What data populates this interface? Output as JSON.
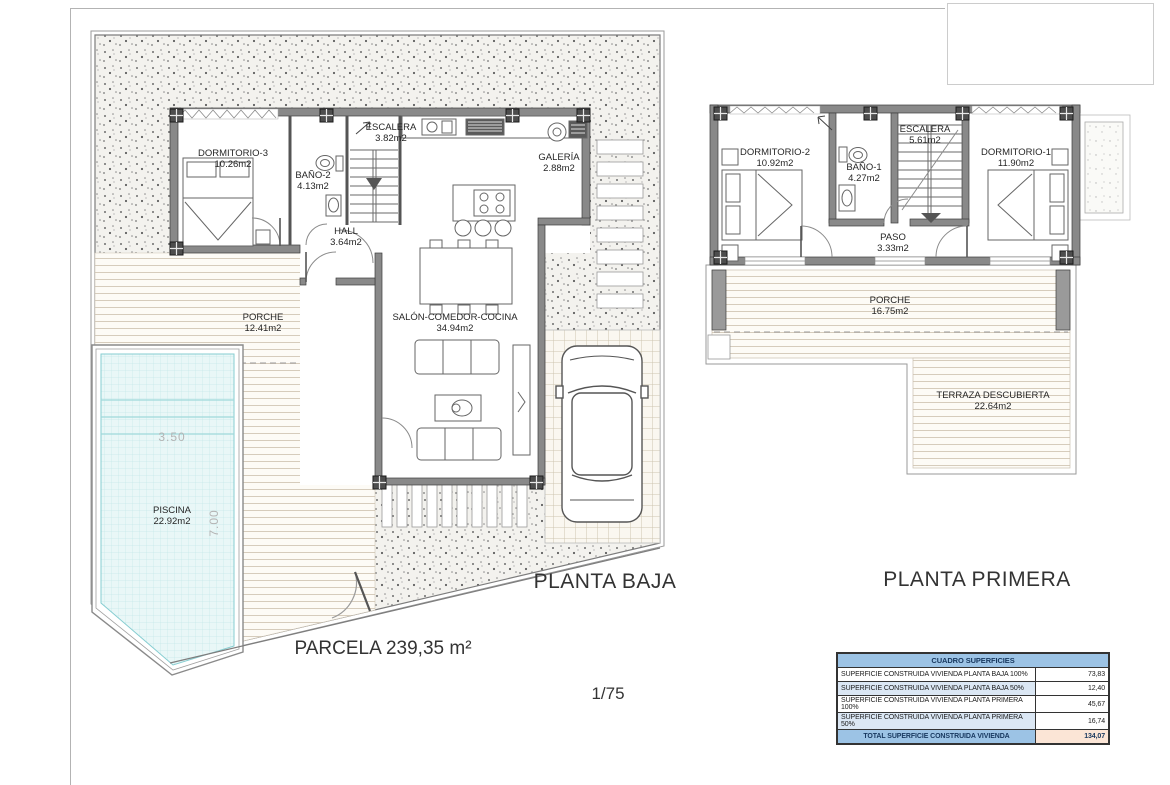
{
  "drawing": {
    "parcel_label": "PARCELA 239,35 m²",
    "scale": "1/75"
  },
  "floors": {
    "ground": {
      "title": "PLANTA BAJA",
      "rooms": [
        {
          "name": "DORMITORIO-3",
          "area": "10.26m2"
        },
        {
          "name": "BAÑO-2",
          "area": "4.13m2"
        },
        {
          "name": "ESCALERA",
          "area": "3.82m2"
        },
        {
          "name": "GALERÍA",
          "area": "2.88m2"
        },
        {
          "name": "HALL",
          "area": "3.64m2"
        },
        {
          "name": "SALÓN-COMEDOR-COCINA",
          "area": "34.94m2"
        },
        {
          "name": "PORCHE",
          "area": "12.41m2"
        },
        {
          "name": "PISCINA",
          "area": "22.92m2"
        }
      ],
      "pool_dims": {
        "width": "3.50",
        "length": "7.00"
      }
    },
    "first": {
      "title": "PLANTA PRIMERA",
      "rooms": [
        {
          "name": "DORMITORIO-2",
          "area": "10.92m2"
        },
        {
          "name": "BAÑO-1",
          "area": "4.27m2"
        },
        {
          "name": "ESCALERA",
          "area": "5.61m2"
        },
        {
          "name": "DORMITORIO-1",
          "area": "11.90m2"
        },
        {
          "name": "PASO",
          "area": "3.33m2"
        },
        {
          "name": "PORCHE",
          "area": "16.75m2"
        },
        {
          "name": "TERRAZA DESCUBIERTA",
          "area": "22.64m2"
        }
      ]
    }
  },
  "table": {
    "title": "CUADRO SUPERFICIES",
    "rows": [
      {
        "label": "SUPERFICIE CONSTRUIDA VIVIENDA PLANTA BAJA 100%",
        "value": "73,83"
      },
      {
        "label": "SUPERFICIE CONSTRUIDA VIVIENDA PLANTA BAJA 50%",
        "value": "12,40"
      },
      {
        "label": "SUPERFICIE CONSTRUIDA VIVIENDA PLANTA PRIMERA 100%",
        "value": "45,67"
      },
      {
        "label": "SUPERFICIE CONSTRUIDA VIVIENDA PLANTA PRIMERA 50%",
        "value": "16,74"
      }
    ],
    "total": {
      "label": "TOTAL SUPERFICIE CONSTRUIDA VIVIENDA",
      "value": "134,07"
    }
  },
  "colors": {
    "wall": "#898989",
    "pool_water": "#e9f7f7",
    "table_header": "#9cc3e5",
    "table_alt_row": "#dbe7f4",
    "table_total_value_bg": "#fbe5d6",
    "table_header_text": "#17375e"
  }
}
